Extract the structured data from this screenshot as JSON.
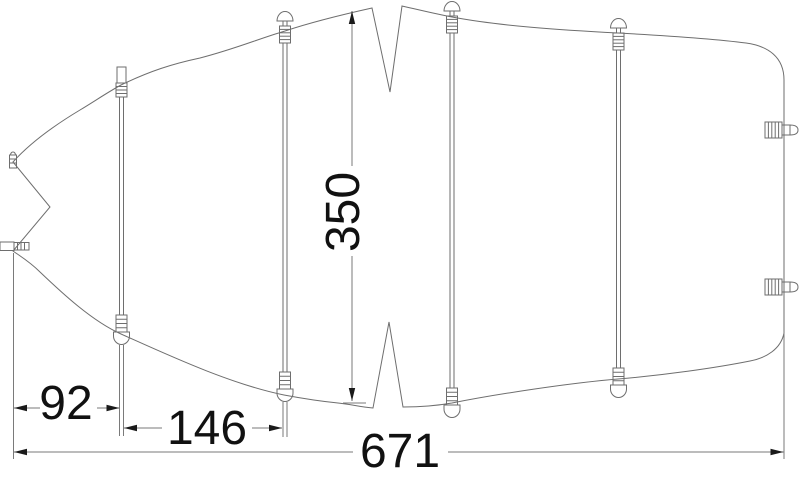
{
  "page": {
    "background": "#ffffff"
  },
  "drawing": {
    "kind": "boat-cover-plan-technical-drawing",
    "line_color": "#6e6e6e",
    "text_color": "#111111",
    "dimensions": {
      "bow_to_first_batten": "92",
      "first_to_second_batten": "146",
      "overall_length": "671",
      "overall_width": "350"
    }
  }
}
